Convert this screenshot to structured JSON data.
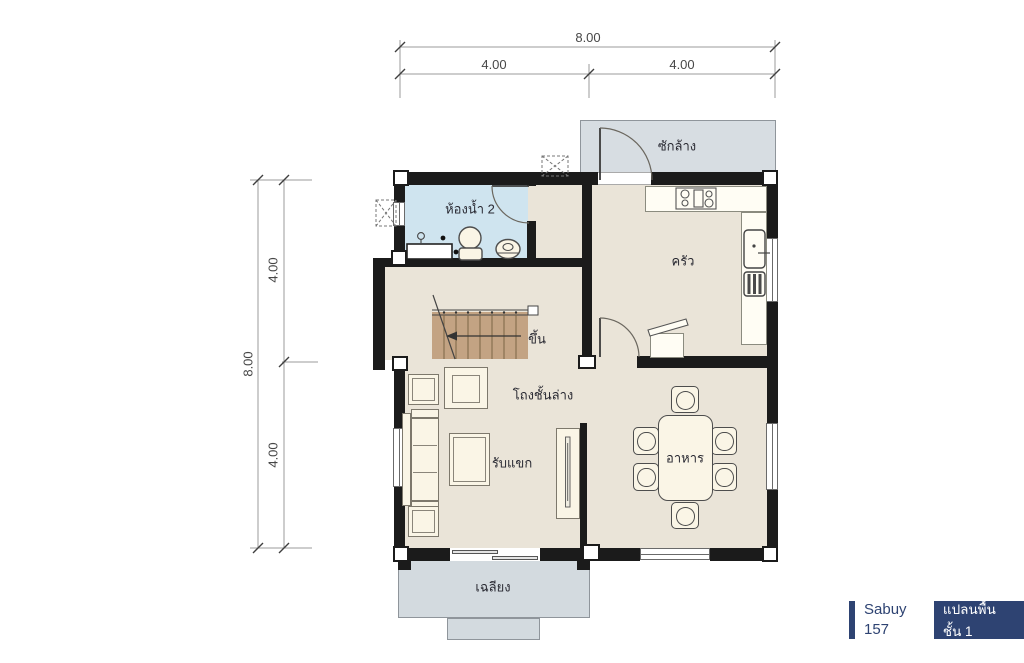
{
  "plan": {
    "rooms": {
      "laundry": "ซักล้าง",
      "bathroom": "ห้องน้ำ 2",
      "kitchen": "ครัว",
      "stairs_up": "ขึ้น",
      "hall": "โถงชั้นล่าง",
      "living": "รับแขก",
      "dining": "อาหาร",
      "porch": "เฉลียง"
    },
    "dimensions": {
      "top": {
        "total": "8.00",
        "segments": [
          "4.00",
          "4.00"
        ]
      },
      "left": {
        "total": "8.00",
        "segments": [
          "4.00",
          "4.00"
        ]
      }
    },
    "badge": {
      "brand": "Sabuy 157",
      "plan_label": "แปลนพื้นชั้น 1"
    },
    "colors": {
      "wall": "#1b1b1b",
      "floor": "#eae4d8",
      "bathroom_floor": "#cfe4ef",
      "service_area": "#d7dde2",
      "stairs": "#c3a383",
      "accent_navy": "#2e4372",
      "furniture": "#faf5e6"
    }
  }
}
